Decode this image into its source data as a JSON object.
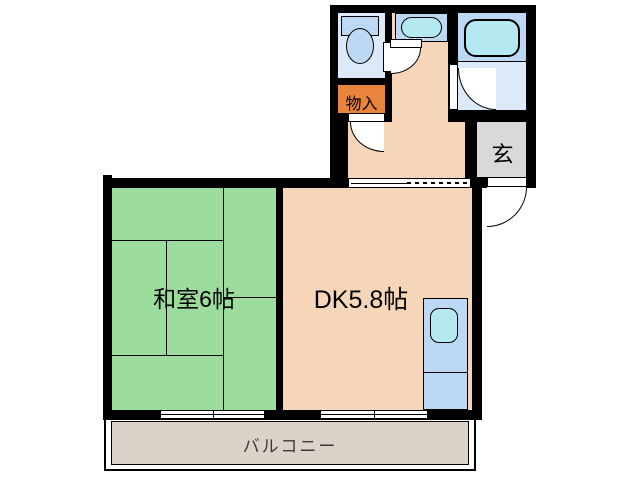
{
  "floorplan": {
    "title": "apartment-floor-plan",
    "rooms": {
      "washitsu": {
        "label": "和室6帖"
      },
      "dk": {
        "label": "DK5.8帖"
      },
      "genkan": {
        "label": "玄"
      },
      "storage": {
        "label": "物入"
      },
      "balcony": {
        "label": "バルコニー"
      }
    },
    "fixtures": {
      "toilet": "toilet-icon",
      "washbasin": "washbasin-icon",
      "bathtub": "bathtub-icon",
      "kitchen_sink": "kitchen-sink-icon"
    },
    "colors": {
      "wall": "#000000",
      "dk_floor": "#F5D6B9",
      "tatami_green": "#9CDC9C",
      "fixture_blue": "#BDD8F2",
      "water_cyan": "#B4E9F1",
      "wet_room_floor": "#DCE9F8",
      "genkan_gray": "#D9D9D9",
      "balcony_floor": "#DBD3C9",
      "storage_orange": "#E8843C",
      "balcony_text": "#3A3A3A"
    }
  }
}
